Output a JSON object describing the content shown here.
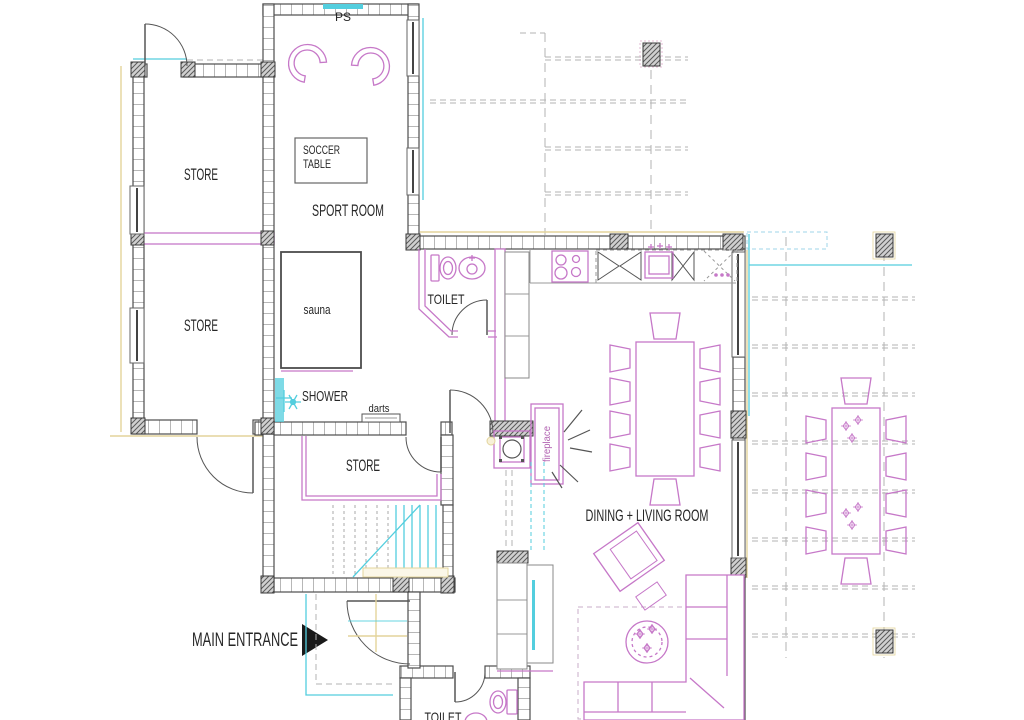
{
  "labels": {
    "ps": "PS",
    "soccer_line1": "SOCCER",
    "soccer_line2": "TABLE",
    "sport_room": "SPORT ROOM",
    "store_top": "STORE",
    "store_mid": "STORE",
    "store_lower": "STORE",
    "sauna": "sauna",
    "shower": "SHOWER",
    "darts": "darts",
    "toilet_upper": "TOILET",
    "toilet_lower": "TOILET",
    "dining_living": "DINING + LIVING ROOM",
    "fireplace": "fireplace",
    "main_entrance": "MAIN ENTRANCE"
  },
  "colors": {
    "wall": "#4d4d4d",
    "furniture": "#c678c8",
    "furniture_light": "#d9a0d9",
    "cyan": "#53cede",
    "tan": "#e3d49b",
    "grid": "#b3b3b3",
    "text": "#262626"
  }
}
